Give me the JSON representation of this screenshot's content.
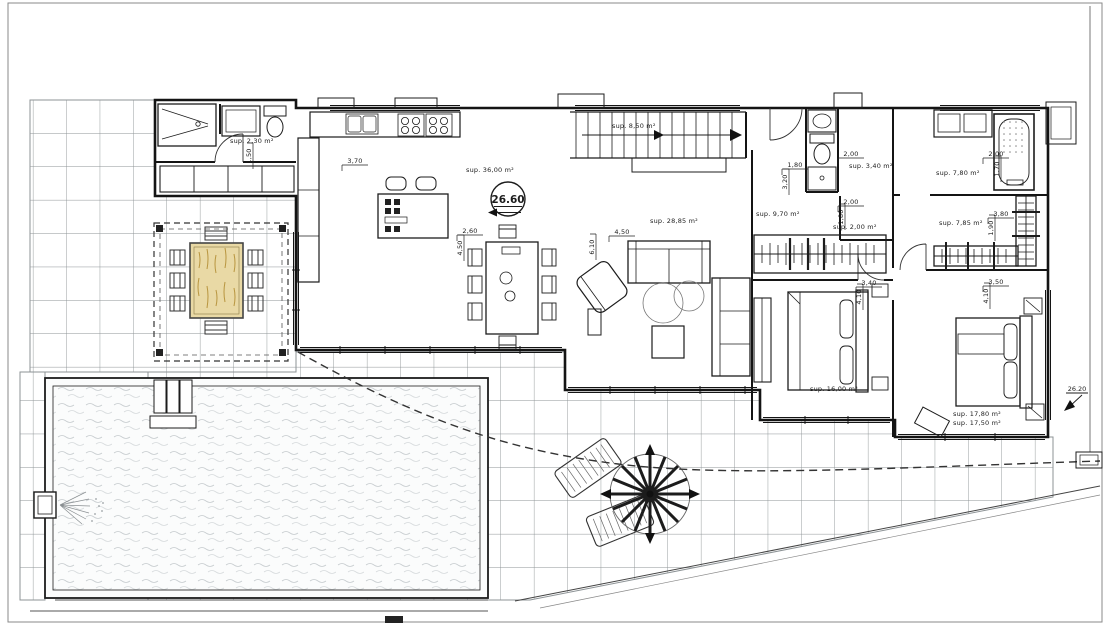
{
  "colors": {
    "line": "#1c1c1c",
    "grid": "#8d9396",
    "wood": "#e9d9a5",
    "paper": "#ffffff"
  },
  "levels": {
    "main": {
      "value": "26.60"
    },
    "terrace": {
      "value": "26.20"
    }
  },
  "rooms": [
    {
      "name": "entry-wc",
      "area": "sup. 2,30 m²"
    },
    {
      "name": "kitchen-living",
      "area": "sup. 36,00 m²"
    },
    {
      "name": "stairs",
      "area": "sup. 8,50 m²"
    },
    {
      "name": "living-room",
      "area": "sup. 28,85 m²"
    },
    {
      "name": "hallway",
      "area": "sup. 9,70 m²"
    },
    {
      "name": "closet",
      "area": "sup. 2,00 m²"
    },
    {
      "name": "bathroom-1",
      "area": "sup. 3,40 m²"
    },
    {
      "name": "bathroom-2",
      "area": "sup. 7,80 m²"
    },
    {
      "name": "dressing",
      "area": "sup. 7,85 m²"
    },
    {
      "name": "bedroom-1",
      "area": "sup. 16,00 m²"
    },
    {
      "name": "bedroom-2",
      "area": "sup. 17,80 m²"
    },
    {
      "name": "bedroom-2-alt",
      "area": "sup. 17,50 m²"
    }
  ],
  "dimensions": [
    {
      "value": "1,50"
    },
    {
      "value": "3,70"
    },
    {
      "value": "2,60"
    },
    {
      "value": "4,50"
    },
    {
      "value": "4,50"
    },
    {
      "value": "6,10"
    },
    {
      "value": "1,80"
    },
    {
      "value": "3,20"
    },
    {
      "value": "2,00"
    },
    {
      "value": "2,00"
    },
    {
      "value": "1,80"
    },
    {
      "value": "3,40"
    },
    {
      "value": "4,10"
    },
    {
      "value": "2,00"
    },
    {
      "value": "1,70"
    },
    {
      "value": "3,80"
    },
    {
      "value": "1,90"
    },
    {
      "value": "3,50"
    },
    {
      "value": "4,10"
    }
  ]
}
